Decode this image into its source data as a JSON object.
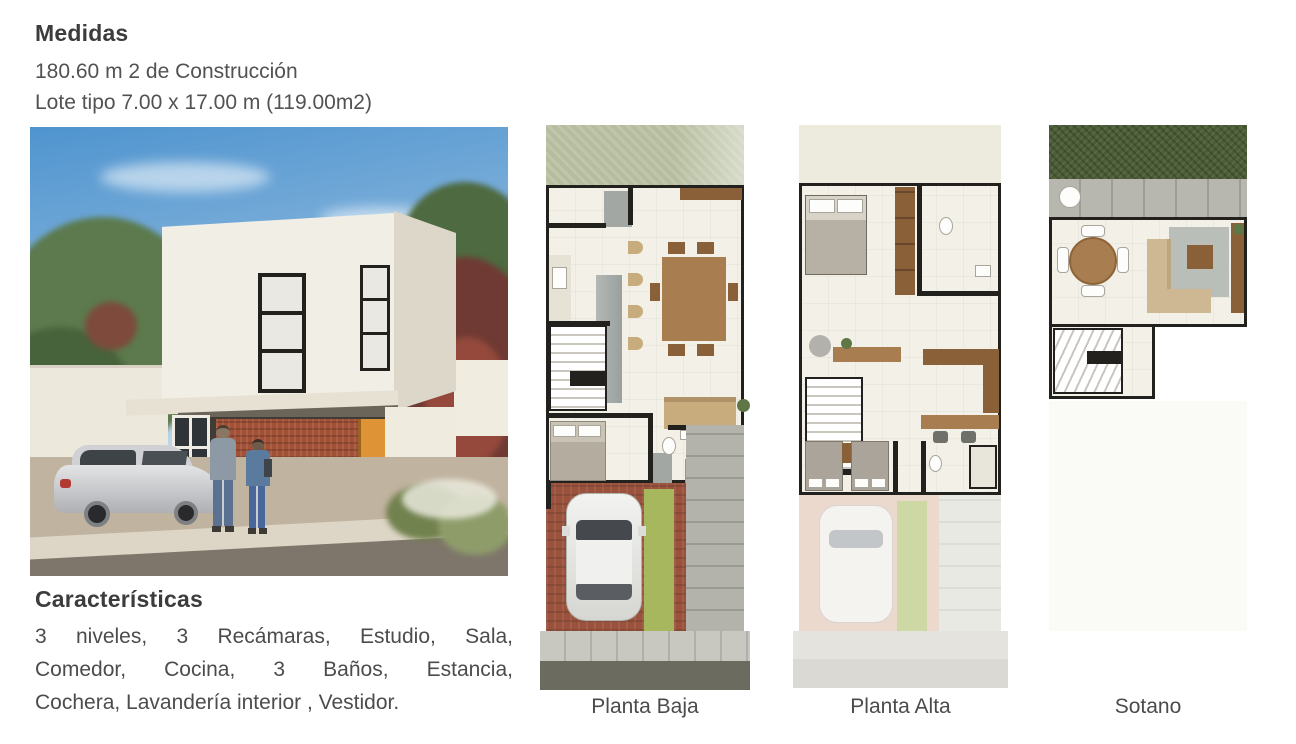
{
  "medidas": {
    "title": "Medidas",
    "lines": [
      "180.60 m 2 de Construcción",
      "Lote tipo 7.00 x 17.00 m (119.00m2)"
    ]
  },
  "caracteristicas": {
    "title": "Características",
    "lines": [
      "3 niveles, 3 Recámaras, Estudio, Sala,",
      "Comedor, Cocina, 3 Baños, Estancia,",
      "Cochera, Lavandería interior , Vestidor."
    ]
  },
  "floorplans": [
    {
      "label": "Planta Baja"
    },
    {
      "label": "Planta Alta"
    },
    {
      "label": "Sotano"
    }
  ],
  "palette": {
    "wall_line": "#23211d",
    "floor_cream": "#f3f0e7",
    "garden_sage": "#b6bd9e",
    "garden_dark": "#4b5c36",
    "driveway_brick": "#9a523c",
    "grass_strip": "#a6b75e",
    "stone_gray": "#b3b3ac",
    "furniture_wood": "#a87e50",
    "facade_brick": "#a35136",
    "door_wood": "#de9336",
    "sky_blue": "#4f94cf",
    "heading_text": "#3c3c3c",
    "body_text": "#4c4c4c"
  }
}
